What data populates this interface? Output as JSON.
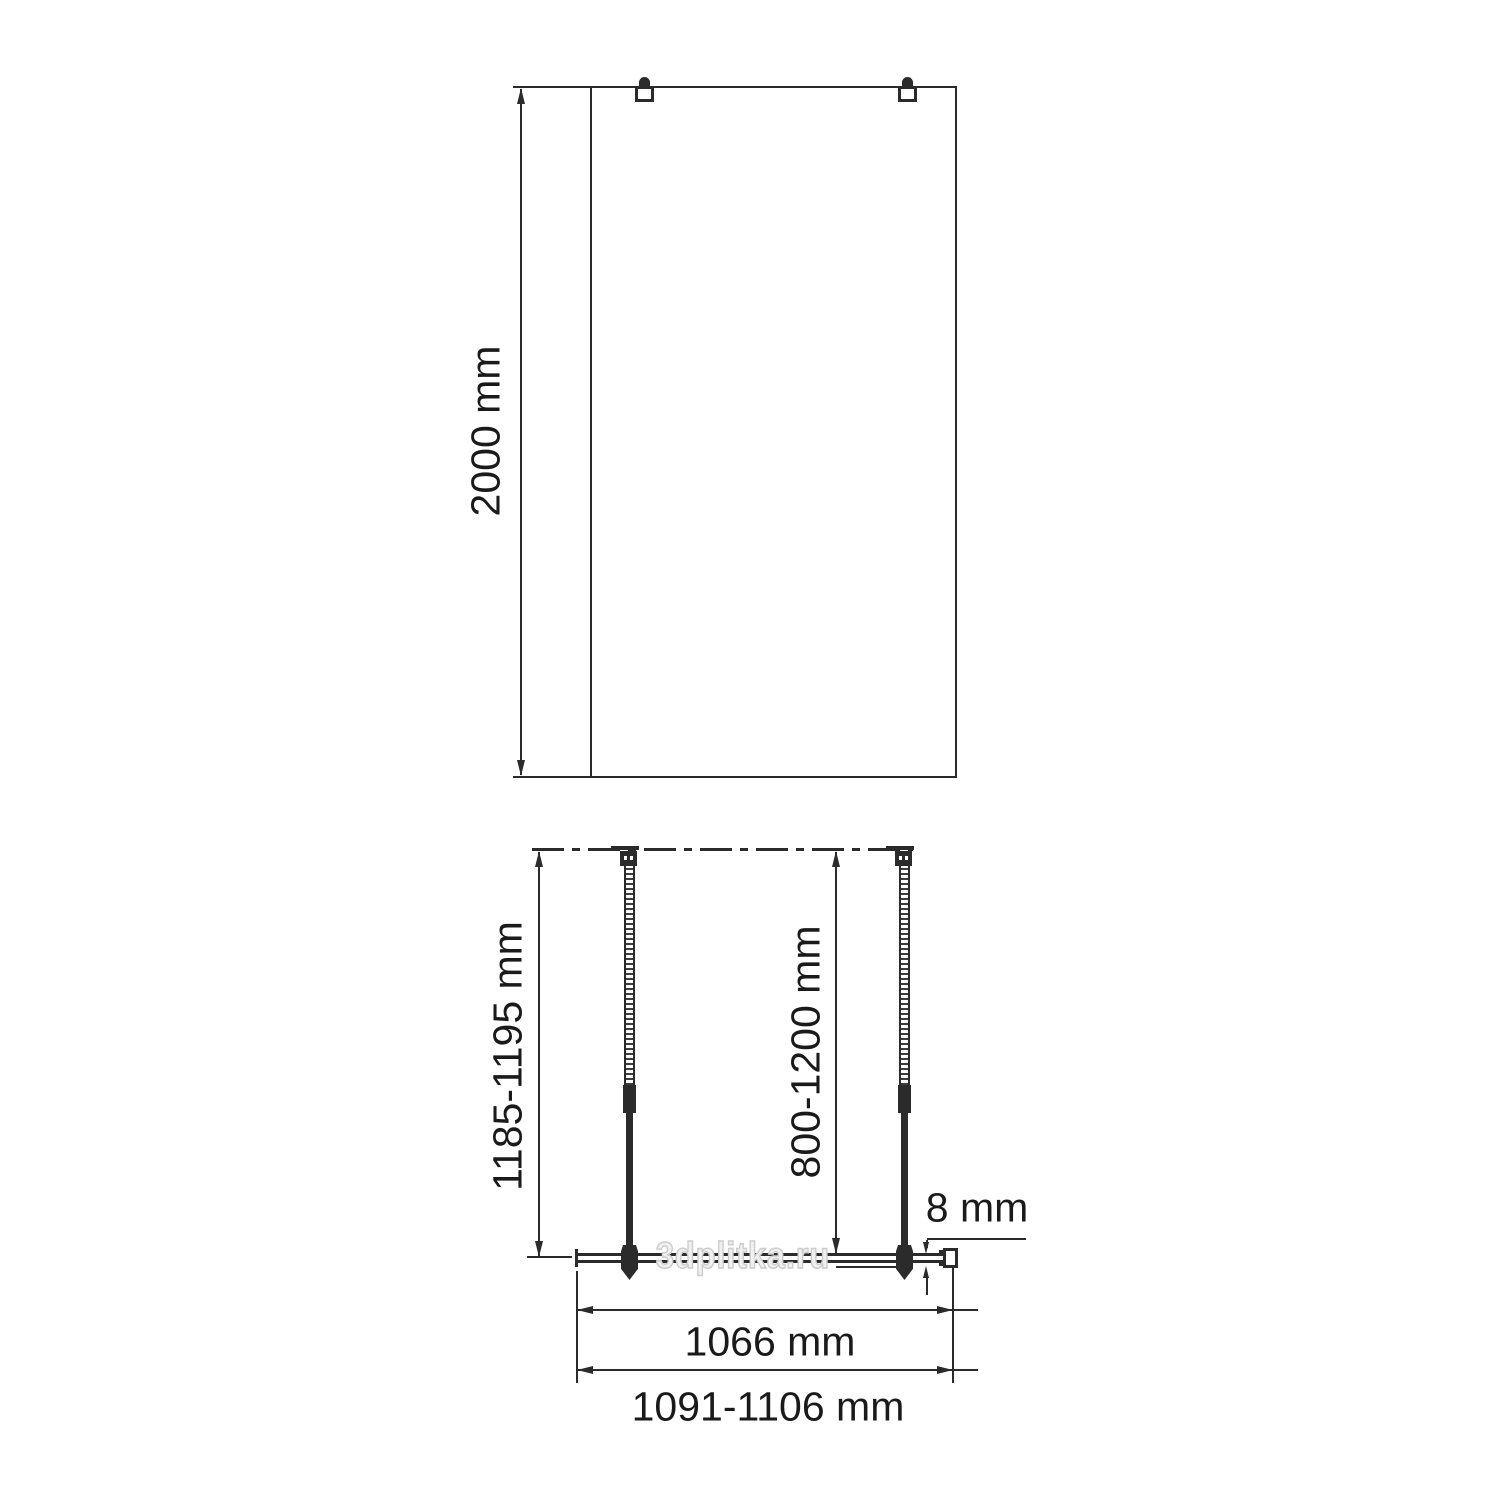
{
  "drawing": {
    "front_view": {
      "height_dimension": "2000 mm"
    },
    "plan_view": {
      "wall_offset_dimension": "1185-1195 mm",
      "support_bar_dimension": "800-1200 mm",
      "glass_thickness_dimension": "8 mm",
      "glass_width_dimension": "1066 mm",
      "overall_width_dimension": "1091-1106 mm"
    },
    "watermark_text": "3dplitka.ru"
  },
  "colors": {
    "line": "#2b2b2b",
    "text": "#1a1a1a",
    "watermark-stroke": "#cccccc",
    "watermark-fill": "#f0f0f0"
  }
}
